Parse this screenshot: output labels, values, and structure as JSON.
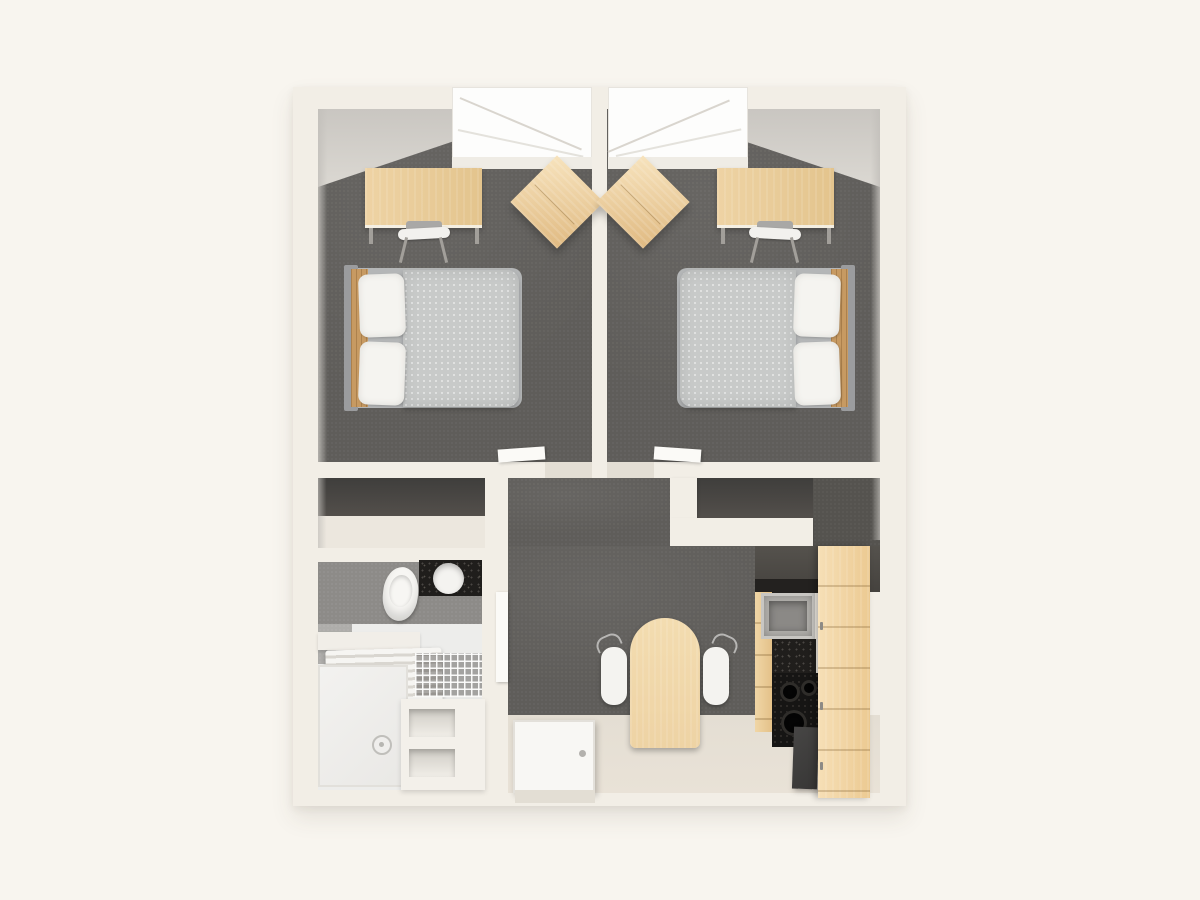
{
  "scene": {
    "type": "3d-floor-plan-render",
    "view": "top-down isometric",
    "rooms": [
      {
        "name": "bedroom-left",
        "furniture": [
          "double-bed",
          "desk",
          "desk-chair",
          "wardrobe-box",
          "window"
        ]
      },
      {
        "name": "bedroom-right",
        "furniture": [
          "double-bed",
          "desk",
          "desk-chair",
          "wardrobe-box",
          "window"
        ]
      },
      {
        "name": "storage-alcove-left",
        "furniture": []
      },
      {
        "name": "storage-alcove-right",
        "furniture": []
      },
      {
        "name": "bathroom",
        "furniture": [
          "toilet",
          "vanity-counter",
          "round-basin",
          "towel-radiator",
          "wire-shelf",
          "shower-tray",
          "drain",
          "storage-cubbies",
          "door"
        ]
      },
      {
        "name": "entry-hall",
        "furniture": [
          "front-door-open-flat",
          "dining-table-arched",
          "chair-left",
          "chair-right"
        ]
      },
      {
        "name": "kitchenette",
        "furniture": [
          "upper-dark-cabinet",
          "metal-sink",
          "speckled-counter",
          "hob-burners",
          "fridge",
          "drawer-fronts",
          "tall-wood-cabinet"
        ]
      }
    ]
  },
  "palette": {
    "bg": "#f8f5ef",
    "wall": "#f2eee6",
    "wall_shadow": "#dcd7cc",
    "wall_face": "#c9c6c0",
    "carpet": "#5f5d5a",
    "carpet_dark": "#55534f",
    "wood": "#eed3a4",
    "wood_dark": "#e0ba82",
    "wood_cabinet": "#ecca92",
    "bed_duvet": "#c8cac9",
    "bed_frame": "#9b9c9e",
    "headboard_wood": "#c79a62",
    "pillow": "#f5f4f0",
    "window": "#fdfdfc",
    "alcove_back": "#534f4b",
    "alcove_floor": "#ece7de",
    "bath_wall": "#8d8b88",
    "bath_floor": "#ededeb",
    "entry_floor": "#e9e2d7",
    "counter_black": "#201e1c",
    "appliance_gray": "#45423e",
    "appliance_dark": "#373635",
    "hob_black": "#161514",
    "metal": "#b3b1ad",
    "metal_dark": "#8b8986"
  }
}
